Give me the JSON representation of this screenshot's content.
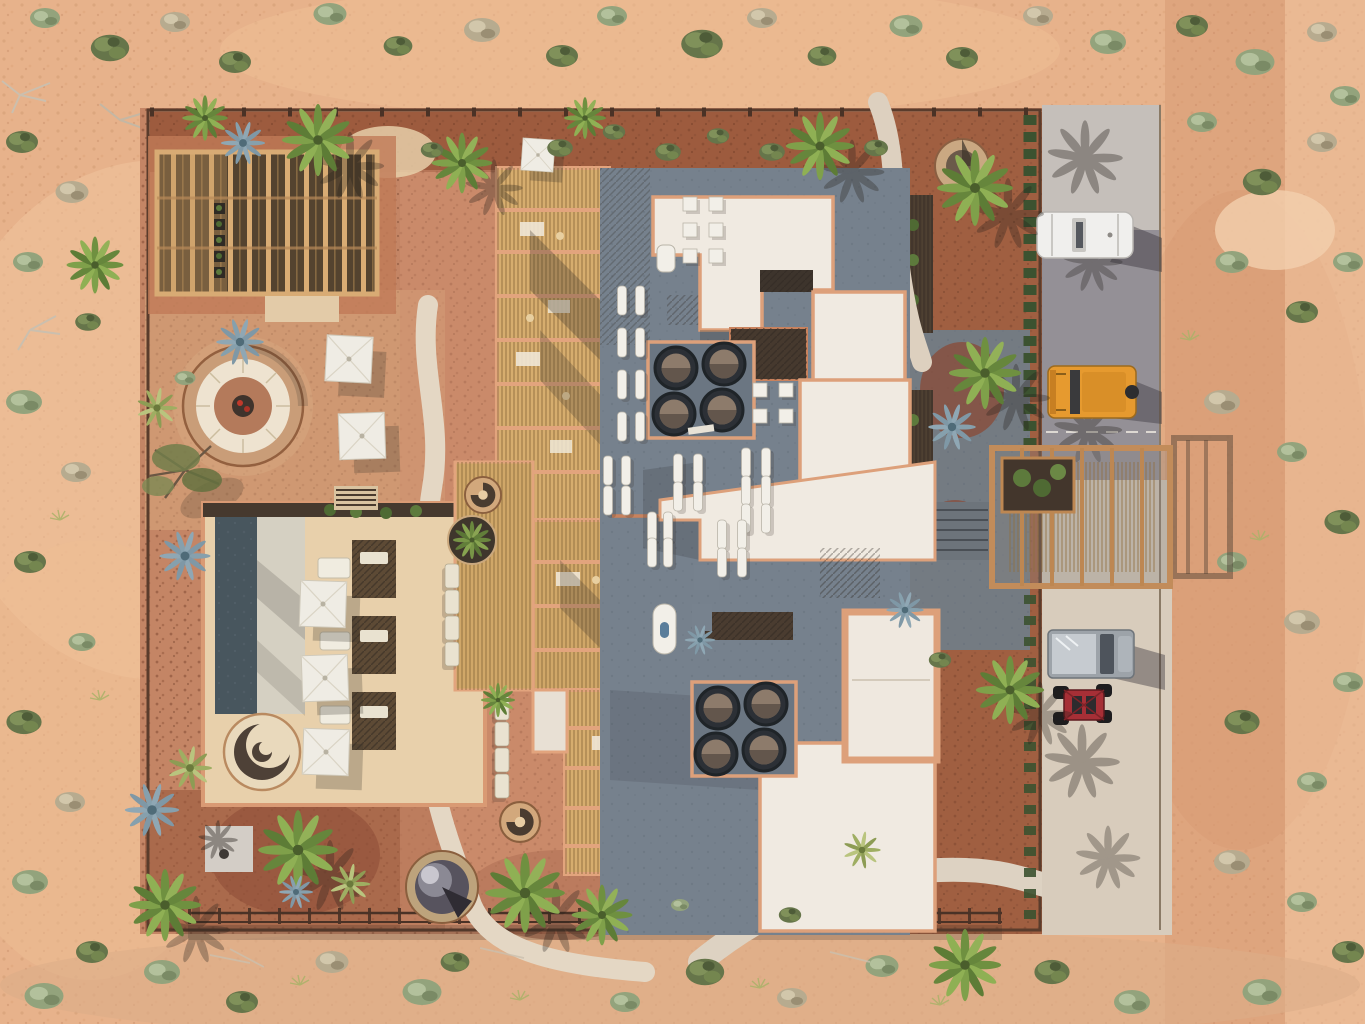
{
  "scene": {
    "type": "aerial-architectural-rendering",
    "setting": "desert-resort-compound",
    "time_of_day": "daylight-hard-shadows"
  },
  "palette": {
    "sand_base": "#e7b28b",
    "sand_light": "#f0c49e",
    "mulch_red": "#9c5a3d",
    "compound_gravel": "#c48565",
    "driveway_asphalt": "#8e8b92",
    "driveway_concrete": "#d8ccbc",
    "path_concrete": "#e4d7c4",
    "roof_gray": "#76818d",
    "roof_white": "#f0eae1",
    "parapet_salmon": "#dda07a",
    "wheat_pergola": "#d6ad6e",
    "wood_frame": "#c28c5a",
    "pergola_interior": "#54432f",
    "pool_water": "#48565e",
    "pool_beach": "#d5d0c2",
    "deck_cream": "#e8d0ab",
    "fire_pit_ring": "#c99d78",
    "dome_gray": "#57535e",
    "hedge_green": "#3c5230",
    "palm_green": "#7fa04a",
    "agave_blue": "#86a0ad",
    "suv_white": "#f0efed",
    "jeep_orange": "#e69a2f",
    "truck_gray": "#9da3a9",
    "utv_red": "#a62f36",
    "shadow": "#2f2a26"
  },
  "objects": {
    "vehicles": [
      {
        "id": "white-suv",
        "label": "white SUV",
        "color_key": "suv_white"
      },
      {
        "id": "orange-jeep",
        "label": "orange off-road SUV",
        "color_key": "jeep_orange"
      },
      {
        "id": "gray-pickup",
        "label": "gray pickup truck",
        "color_key": "truck_gray"
      },
      {
        "id": "red-utv",
        "label": "red side-by-side UTV",
        "color_key": "utv_red"
      }
    ],
    "amenities": [
      "timber-pergola-lounge",
      "sunken-fire-pit",
      "swimming-pool",
      "beach-entry-deck",
      "spiral-spa",
      "square-sun-umbrellas",
      "sun-loungers",
      "spiral-staircases",
      "domed-pavilion",
      "roof-skylights",
      "round-roof-vents",
      "carport-pergola",
      "gravel-driveway",
      "stone-fire-bowl",
      "garden-terrace"
    ],
    "vegetation": [
      "palm-trees",
      "desert-shrubs",
      "blue-agaves",
      "mesquite-tree",
      "perimeter-hedges"
    ]
  }
}
